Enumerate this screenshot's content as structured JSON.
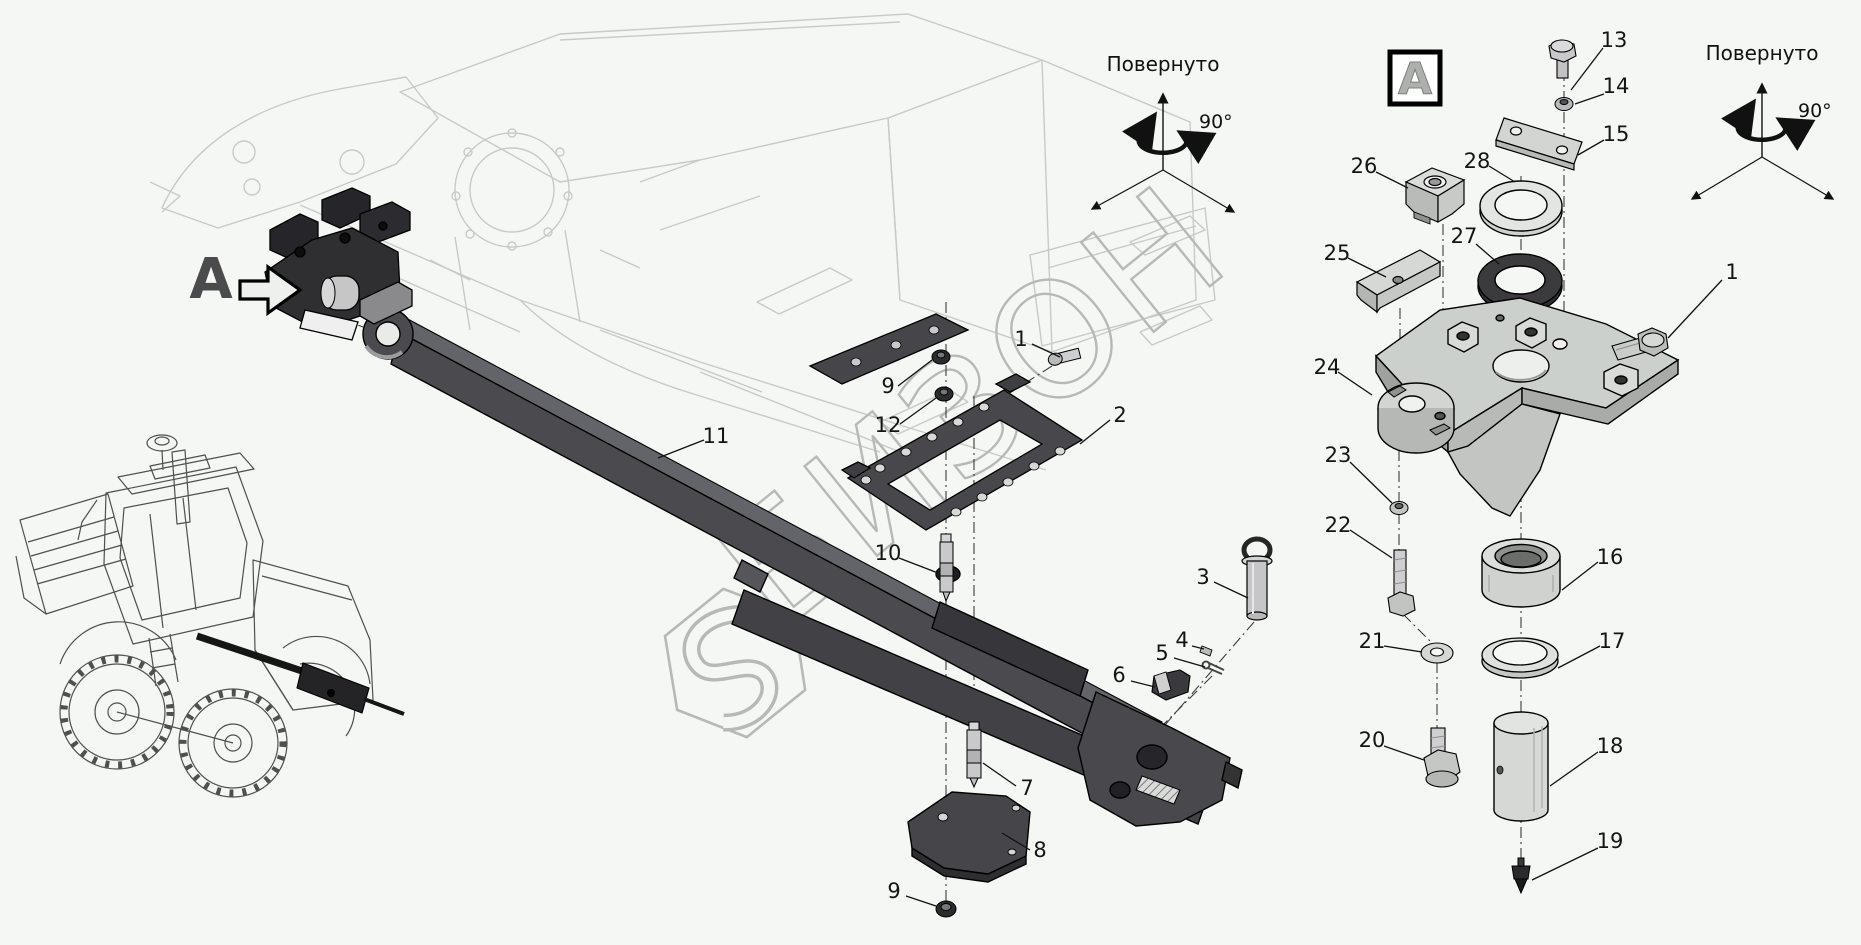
{
  "watermark": {
    "text": "БИЗОН"
  },
  "detail_marker": {
    "label": "A"
  },
  "detail_box": {
    "label": "A"
  },
  "rotation_note_center": {
    "title": "Повернуто",
    "angle": "90°"
  },
  "rotation_note_right": {
    "title": "Повернуто",
    "angle": "90°"
  },
  "callouts": {
    "c1": "1",
    "c2": "2",
    "c3": "3",
    "c4": "4",
    "c5": "5",
    "c6": "6",
    "c7": "7",
    "c8": "8",
    "c9_upper": "9",
    "c9_lower": "9",
    "c10": "10",
    "c11": "11",
    "c12": "12",
    "c13": "13",
    "c14": "14",
    "c15": "15",
    "c16": "16",
    "c17": "17",
    "c18": "18",
    "c19": "19",
    "c20": "20",
    "c21": "21",
    "c22": "22",
    "c23": "23",
    "c24": "24",
    "c25": "25",
    "c26": "26",
    "c27": "27",
    "c28": "28",
    "c1_right": "1"
  }
}
